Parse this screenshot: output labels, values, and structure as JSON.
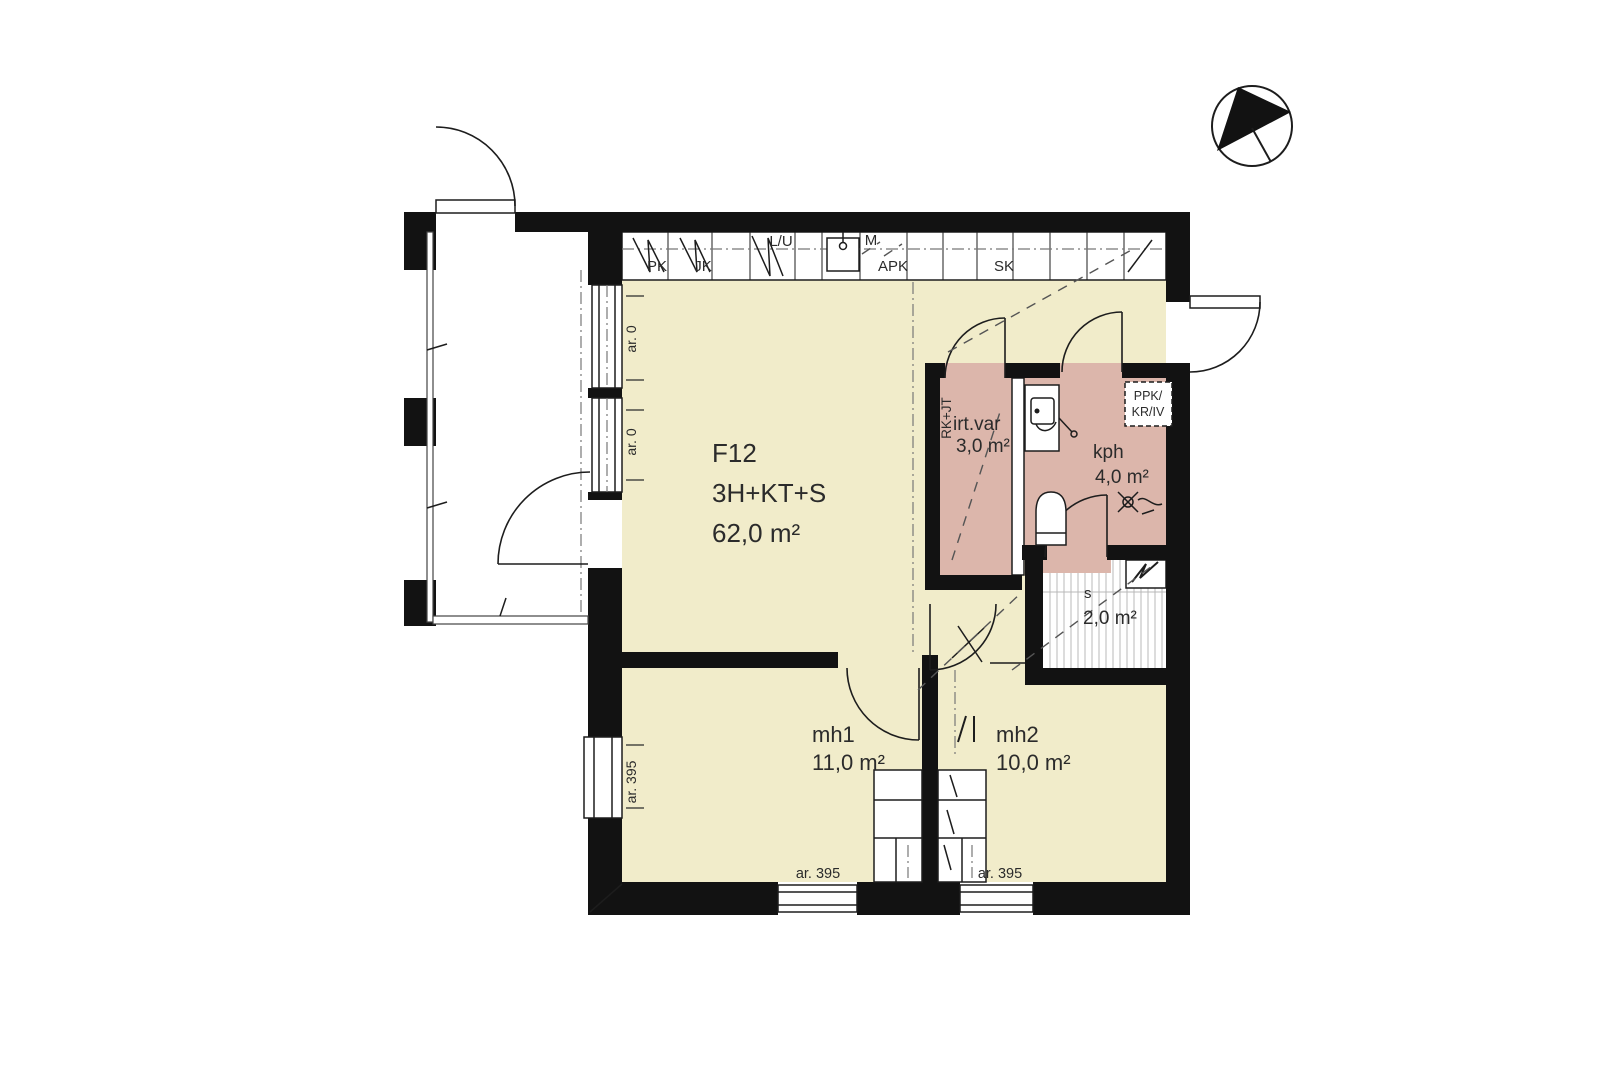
{
  "unit": {
    "id": "F12",
    "layout": "3H+KT+S",
    "area": "62,0 m²"
  },
  "rooms": {
    "bedroom1": {
      "name": "mh1",
      "area": "11,0 m²"
    },
    "bedroom2": {
      "name": "mh2",
      "area": "10,0 m²"
    },
    "bathroom": {
      "name": "kph",
      "area": "4,0 m²"
    },
    "sauna": {
      "name": "s",
      "area": "2,0 m²"
    },
    "storage": {
      "name": "irt.var",
      "area": "3,0 m²",
      "duct_label": "RK+JT"
    }
  },
  "kitchen": {
    "labels": {
      "pk": "PK",
      "jk": "JK",
      "lu": "L/U",
      "m": "M",
      "apk": "APK",
      "sk": "SK"
    }
  },
  "reserved_appliance": {
    "line1": "PPK/",
    "line2": "KR/IV"
  },
  "window_markings": {
    "left_window_top": "ar. 0",
    "left_window_mid": "ar. 0",
    "left_window_low": "ar. 395",
    "bottom_window_left": "ar. 395",
    "bottom_window_right": "ar. 395"
  },
  "colors": {
    "floor_dry": "#f1ecca",
    "floor_wet": "#dcb6ab",
    "wall": "#121212"
  }
}
